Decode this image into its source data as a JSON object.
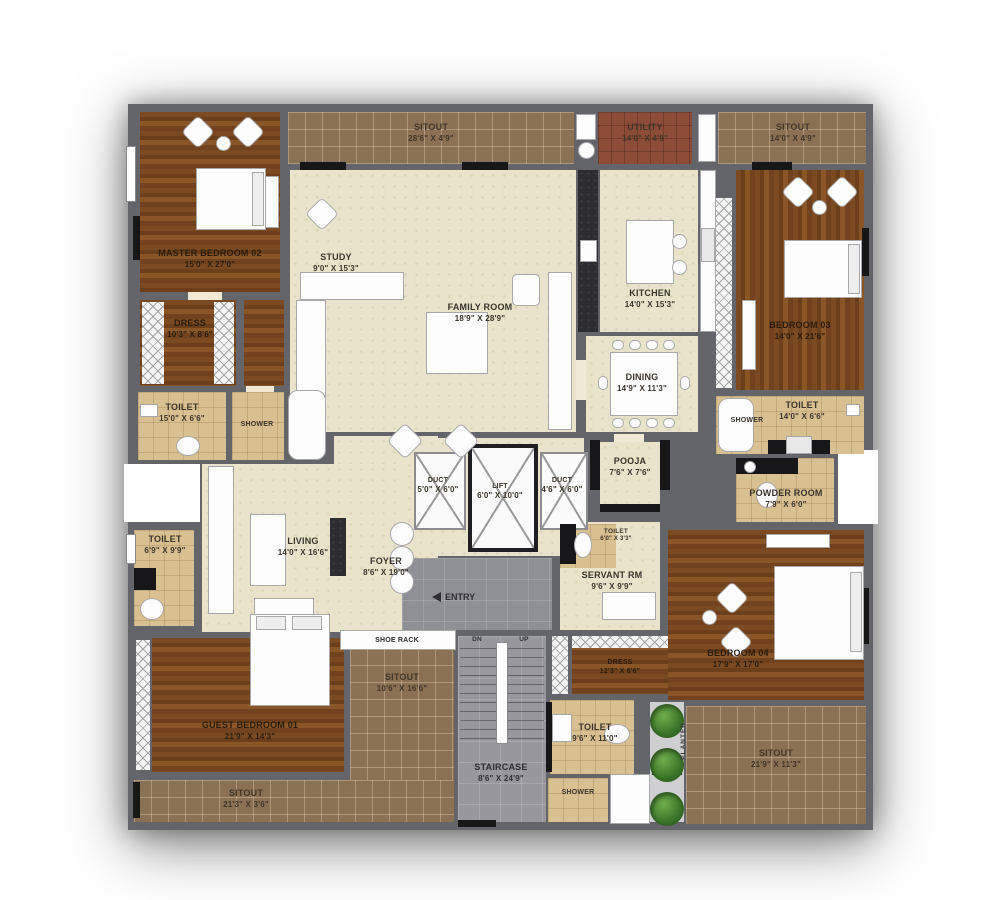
{
  "plan": {
    "title": "apartment-floor-plan",
    "colors": {
      "wall": "#64656b",
      "wood": "#7c4a21",
      "sitout_tile": "#8a7154",
      "utility_tile": "#8c4c38",
      "interior": "#eae3cb",
      "bath_tile": "#d9c091",
      "hard_floor": "#97979d",
      "accent_black": "#17171a",
      "plant_green": "#3a7427"
    },
    "rooms": {
      "sitout_top": {
        "name": "SITOUT",
        "dim": "28'6\" X 4'9\""
      },
      "utility": {
        "name": "UTILITY",
        "dim": "14'0\" X 4'9\""
      },
      "sitout_top_right": {
        "name": "SITOUT",
        "dim": "14'0\" X 4'9\""
      },
      "master_bedroom": {
        "name": "MASTER BEDROOM 02",
        "dim": "15'0\" X 27'0\""
      },
      "study": {
        "name": "STUDY",
        "dim": "9'0\" X 15'3\""
      },
      "family_room": {
        "name": "FAMILY ROOM",
        "dim": "18'9\" X 28'9\""
      },
      "kitchen": {
        "name": "KITCHEN",
        "dim": "14'0\" X 15'3\""
      },
      "bedroom_03": {
        "name": "BEDROOM 03",
        "dim": "14'0\" X 21'6\""
      },
      "dress_master": {
        "name": "DRESS",
        "dim": "10'3\" X 8'6\""
      },
      "toilet_master": {
        "name": "TOILET",
        "dim": "15'0\" X 6'6\""
      },
      "shower_master": {
        "name": "SHOWER"
      },
      "dining": {
        "name": "DINING",
        "dim": "14'9\" X 11'3\""
      },
      "shower_right": {
        "name": "SHOWER"
      },
      "toilet_right": {
        "name": "TOILET",
        "dim": "14'0\" X 6'6\""
      },
      "powder_room": {
        "name": "POWDER ROOM",
        "dim": "7'9\" X 6'0\""
      },
      "duct_left": {
        "name": "DUCT",
        "dim": "5'0\" X 6'0\""
      },
      "lift": {
        "name": "LIFT",
        "dim": "6'0\" X 10'0\""
      },
      "duct_right": {
        "name": "DUCT",
        "dim": "4'6\" X 6'0\""
      },
      "pooja": {
        "name": "POOJA",
        "dim": "7'6\" X 7'6\""
      },
      "toilet_living": {
        "name": "TOILET",
        "dim": "6'9\" X 9'9\""
      },
      "living": {
        "name": "LIVING",
        "dim": "14'0\" X 16'6\""
      },
      "foyer": {
        "name": "FOYER",
        "dim": "8'6\" X 19'0\""
      },
      "toilet_servant": {
        "name": "TOILET",
        "dim": "6'0\" X 3'3\""
      },
      "servant_room": {
        "name": "SERVANT RM",
        "dim": "9'6\" X 9'9\""
      },
      "guest_bedroom": {
        "name": "GUEST BEDROOM 01",
        "dim": "21'9\" X 14'3\""
      },
      "sitout_bottom_left": {
        "name": "SITOUT",
        "dim": "21'3\" X 3'6\""
      },
      "sitout_mid": {
        "name": "SITOUT",
        "dim": "10'6\" X 16'6\""
      },
      "staircase": {
        "name": "STAIRCASE",
        "dim": "8'6\" X 24'9\""
      },
      "dress_bottom": {
        "name": "DRESS",
        "dim": "12'3\" X 6'6\""
      },
      "toilet_bottom": {
        "name": "TOILET",
        "dim": "9'6\" X 11'0\""
      },
      "shower_bottom": {
        "name": "SHOWER"
      },
      "bedroom_04": {
        "name": "BEDROOM 04",
        "dim": "17'9\" X 17'0\""
      },
      "sitout_bottom_right": {
        "name": "SITOUT",
        "dim": "21'9\" X 11'3\""
      },
      "planter": {
        "name": "PLANTER"
      }
    },
    "misc": {
      "entry": "ENTRY",
      "shoe_rack": "SHOE RACK",
      "stairs_down": "DN",
      "stairs_up": "UP"
    }
  }
}
